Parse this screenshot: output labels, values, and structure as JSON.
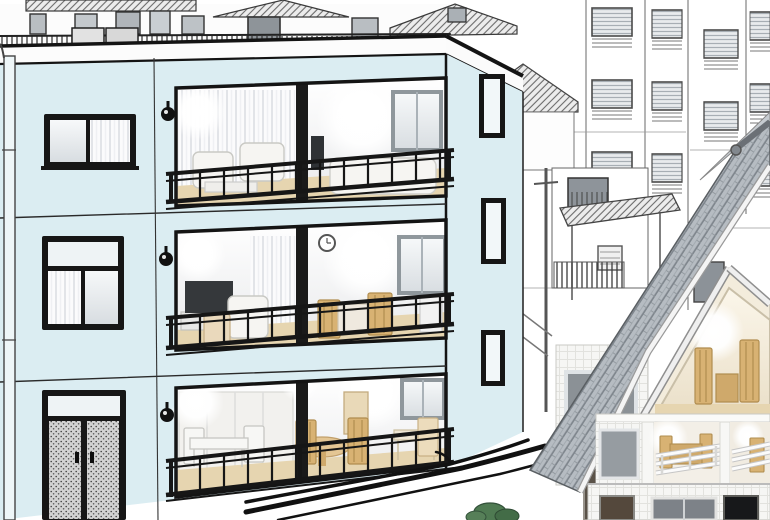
{
  "meta": {
    "width": 770,
    "height": 520,
    "description": "Architectural illustration: line-art residential neighborhood with a light-blue three-story apartment building cut away to reveal furnished interiors, and a gray-tile-roof house with cutaway rooms at right."
  },
  "palette": {
    "background": "#ffffff",
    "ink": "#141414",
    "sketch_line": "#4a4a4a",
    "facade": "#dbedf2",
    "parapet": "#fcfcfc",
    "room_wall_top": "#ffffff",
    "room_wall_bottom": "#e8e9eb",
    "wood_floor": "#e6d5b0",
    "wood_furniture": "#d8b273",
    "white_furniture": "#f6f5f2",
    "tv_dark": "#2f3235",
    "roof_tile": "#b6bcc2",
    "roof_tile_dark": "#7f868d",
    "gable_wall": "#f3ecdc",
    "tile_wall": "#f6f6f4",
    "glass_dark": "#8b9196",
    "railing_black": "#161616",
    "railing_white": "#f8f8f8",
    "glow": "#ffffff",
    "bush": "#4f7a52",
    "curb": "#111111"
  },
  "scene": {
    "style": "black-and-white architectural sketch with soft-rendered cutaway interiors",
    "main_building": {
      "label": "three-story apartment building with light blue facade and cutaway rooms",
      "floors_visible": 3,
      "rooms_per_floor": 2,
      "elements": [
        "roof parapet",
        "rooftop equipment boxes",
        "downspout pipe",
        "wall sconce lamps",
        "black framed windows",
        "frosted-glass double entry door",
        "black balcony railings",
        "white sofas and armchairs",
        "televisions",
        "wooden chairs and round table",
        "curtains",
        "wall clock",
        "glowing ceiling lights",
        "narrow side-wall windows"
      ]
    },
    "right_house": {
      "label": "house with gray tiled roof, white tiled walls and cutaway interiors",
      "elements": [
        "gray kawara tile roof",
        "ridge end tile",
        "cream gable wall",
        "attic room with wooden chairs",
        "balcony rooms with wooden tables",
        "white horizontal railings",
        "dark ground-floor windows",
        "glowing interior lights"
      ]
    },
    "background": {
      "label": "sketched residential neighborhood",
      "elements": [
        "houses with hatched roofs",
        "apartment towers with blinds windows and balcony rails",
        "fence railings",
        "awning",
        "air-conditioner unit",
        "utility pole",
        "street curb lines",
        "green shrubs"
      ]
    }
  }
}
